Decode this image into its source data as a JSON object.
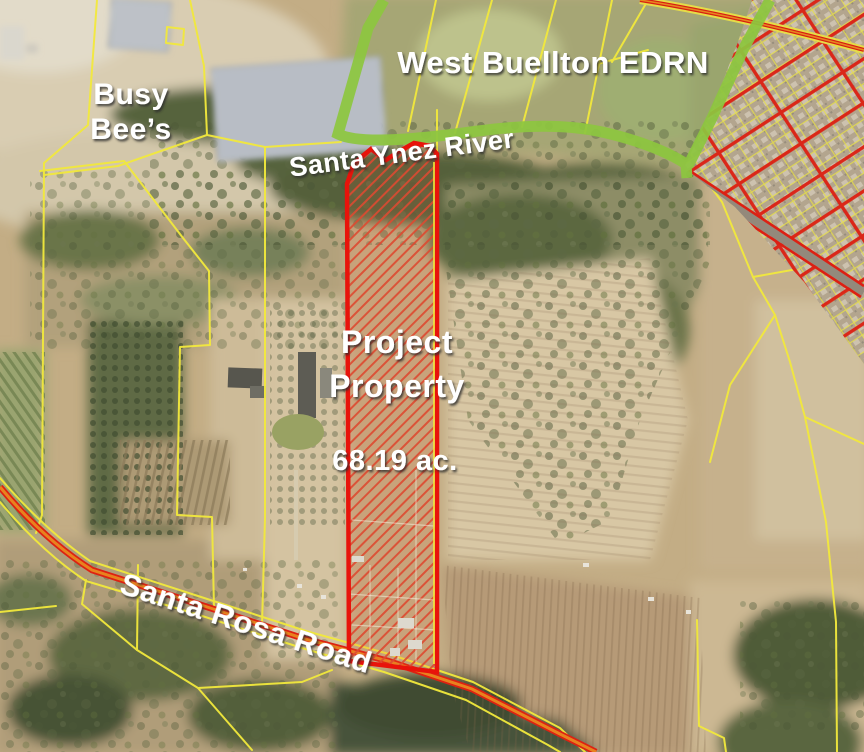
{
  "map": {
    "title": "Aerial project location exhibit",
    "labels": {
      "region": "West Buellton EDRN",
      "business_line1": "Busy",
      "business_line2": "Bee’s",
      "river": "Santa Ynez River",
      "project_line1": "Project",
      "project_line2": "Property",
      "project_acreage": "68.19 ac.",
      "road": "Santa Rosa Road"
    },
    "colors": {
      "edrn_boundary_green": "#8dc63f",
      "project_outline_red": "#e8130b",
      "project_hatch_red": "#dd4a31",
      "parcel_line_yellow": "#f2e93c",
      "road_red": "#de2112",
      "road_orange": "#e8821e",
      "label_white": "#ffffff"
    }
  }
}
